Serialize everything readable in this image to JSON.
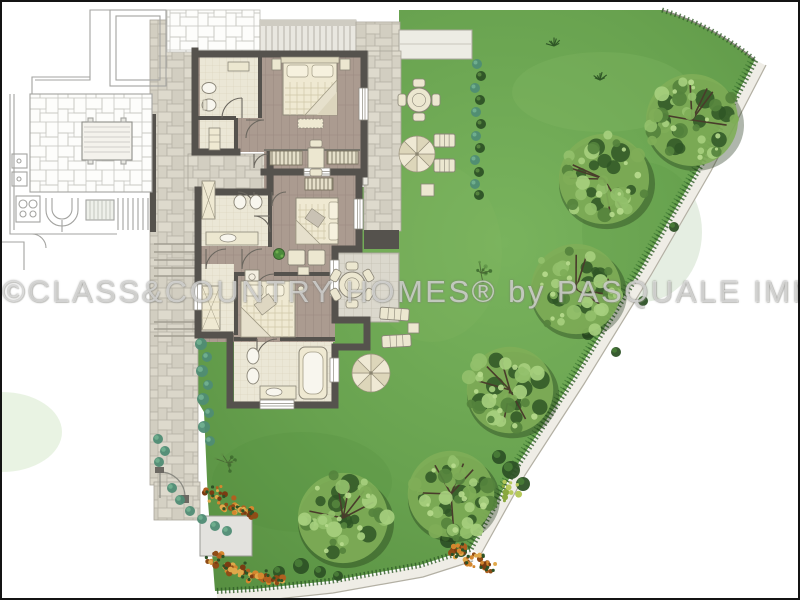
{
  "watermark": {
    "text": "©CLASS&COUNTRY HOMES® by PASQUALE IMMOBILIARE"
  },
  "palette": {
    "lawn_base": "#68a24f",
    "lawn_light": "#7cb45f",
    "lawn_dark": "#578f41",
    "tree_light": "#a6cf7e",
    "tree_mid": "#7fae58",
    "tree_dark": "#55833d",
    "tree_deep": "#2f5626",
    "tree_branch": "#493c2b",
    "wall": "#55524d",
    "wood_floor": "#ab9b90",
    "bath_floor": "#ebe7d6",
    "furniture": "#ece7d0",
    "furniture_stroke": "#8a8577",
    "stone": "#d8d4c8",
    "pale_edge": "#efede6",
    "teal_shrub": "#4f8c74",
    "teal_light": "#6fae8e",
    "bush_dark": "#2d5226",
    "flower_orange": [
      "#d4872e",
      "#b06020",
      "#8f4c16",
      "#e0a84a",
      "#7a3c12"
    ]
  },
  "garden": {
    "trees": [
      {
        "x": 690,
        "y": 118,
        "r": 50
      },
      {
        "x": 602,
        "y": 177,
        "r": 49
      },
      {
        "x": 574,
        "y": 287,
        "r": 49
      },
      {
        "x": 508,
        "y": 388,
        "r": 47
      },
      {
        "x": 449,
        "y": 492,
        "r": 47
      },
      {
        "x": 341,
        "y": 516,
        "r": 49
      }
    ],
    "saplings": [
      {
        "x": 479,
        "y": 271,
        "r": 13
      },
      {
        "x": 226,
        "y": 461,
        "r": 12
      }
    ],
    "yellow_bushes": [
      {
        "x": 507,
        "y": 489,
        "r": 11
      }
    ],
    "tufts": [
      {
        "x": 552,
        "y": 44
      },
      {
        "x": 598,
        "y": 78
      }
    ],
    "teal_hedge": [
      {
        "x": 199,
        "y": 342,
        "r": 6
      },
      {
        "x": 205,
        "y": 355,
        "r": 5
      },
      {
        "x": 200,
        "y": 369,
        "r": 6
      },
      {
        "x": 206,
        "y": 383,
        "r": 5
      },
      {
        "x": 201,
        "y": 397,
        "r": 6
      },
      {
        "x": 207,
        "y": 411,
        "r": 5
      },
      {
        "x": 202,
        "y": 425,
        "r": 6
      },
      {
        "x": 208,
        "y": 439,
        "r": 5
      },
      {
        "x": 156,
        "y": 437,
        "r": 5
      },
      {
        "x": 163,
        "y": 449,
        "r": 5
      },
      {
        "x": 157,
        "y": 460,
        "r": 5
      },
      {
        "x": 170,
        "y": 486,
        "r": 5
      },
      {
        "x": 178,
        "y": 498,
        "r": 5
      },
      {
        "x": 188,
        "y": 509,
        "r": 5
      },
      {
        "x": 200,
        "y": 517,
        "r": 5
      },
      {
        "x": 213,
        "y": 524,
        "r": 5
      },
      {
        "x": 225,
        "y": 529,
        "r": 5
      }
    ],
    "garden_hedge": [
      {
        "x": 475,
        "y": 62,
        "r": 5
      },
      {
        "x": 479,
        "y": 74,
        "r": 5
      },
      {
        "x": 473,
        "y": 86,
        "r": 5
      },
      {
        "x": 478,
        "y": 98,
        "r": 5
      },
      {
        "x": 474,
        "y": 110,
        "r": 5
      },
      {
        "x": 479,
        "y": 122,
        "r": 5
      },
      {
        "x": 474,
        "y": 134,
        "r": 5
      },
      {
        "x": 478,
        "y": 146,
        "r": 5
      },
      {
        "x": 473,
        "y": 158,
        "r": 5
      },
      {
        "x": 477,
        "y": 170,
        "r": 5
      },
      {
        "x": 473,
        "y": 182,
        "r": 5
      },
      {
        "x": 477,
        "y": 193,
        "r": 5
      }
    ],
    "dark_bushes": [
      {
        "x": 509,
        "y": 468,
        "r": 9
      },
      {
        "x": 521,
        "y": 482,
        "r": 7
      },
      {
        "x": 497,
        "y": 455,
        "r": 7
      },
      {
        "x": 446,
        "y": 538,
        "r": 8
      },
      {
        "x": 459,
        "y": 549,
        "r": 6
      },
      {
        "x": 299,
        "y": 564,
        "r": 8
      },
      {
        "x": 318,
        "y": 570,
        "r": 6
      },
      {
        "x": 277,
        "y": 570,
        "r": 6
      },
      {
        "x": 336,
        "y": 574,
        "r": 5
      },
      {
        "x": 586,
        "y": 332,
        "r": 6
      },
      {
        "x": 614,
        "y": 350,
        "r": 5
      },
      {
        "x": 641,
        "y": 299,
        "r": 5
      },
      {
        "x": 672,
        "y": 225,
        "r": 5
      }
    ],
    "flower_clusters": [
      {
        "x": 214,
        "y": 492,
        "r": 13
      },
      {
        "x": 231,
        "y": 503,
        "r": 12
      },
      {
        "x": 245,
        "y": 512,
        "r": 10
      },
      {
        "x": 216,
        "y": 559,
        "r": 12
      },
      {
        "x": 235,
        "y": 568,
        "r": 12
      },
      {
        "x": 254,
        "y": 574,
        "r": 11
      },
      {
        "x": 272,
        "y": 577,
        "r": 9
      },
      {
        "x": 455,
        "y": 549,
        "r": 10
      },
      {
        "x": 472,
        "y": 558,
        "r": 10
      },
      {
        "x": 486,
        "y": 564,
        "r": 8
      }
    ],
    "round_tables": [
      {
        "x": 417,
        "y": 98,
        "r": 12,
        "chairs": 4,
        "dist": 17
      },
      {
        "x": 350,
        "y": 283,
        "r": 13,
        "chairs": 6,
        "dist": 19
      }
    ],
    "parasols": [
      {
        "x": 415,
        "y": 152,
        "r": 18
      },
      {
        "x": 369,
        "y": 371,
        "r": 19
      }
    ],
    "loungers": [
      {
        "x": 378,
        "y": 306,
        "w": 29,
        "h": 12,
        "rot": 4
      },
      {
        "x": 380,
        "y": 333,
        "w": 29,
        "h": 12,
        "rot": -3
      },
      {
        "x": 432,
        "y": 132,
        "w": 21,
        "h": 13,
        "rot": 0
      },
      {
        "x": 432,
        "y": 157,
        "w": 21,
        "h": 13,
        "rot": 0
      }
    ],
    "square_tables": [
      {
        "x": 419,
        "y": 182,
        "w": 13,
        "h": 12
      },
      {
        "x": 406,
        "y": 321,
        "w": 11,
        "h": 10
      }
    ]
  }
}
